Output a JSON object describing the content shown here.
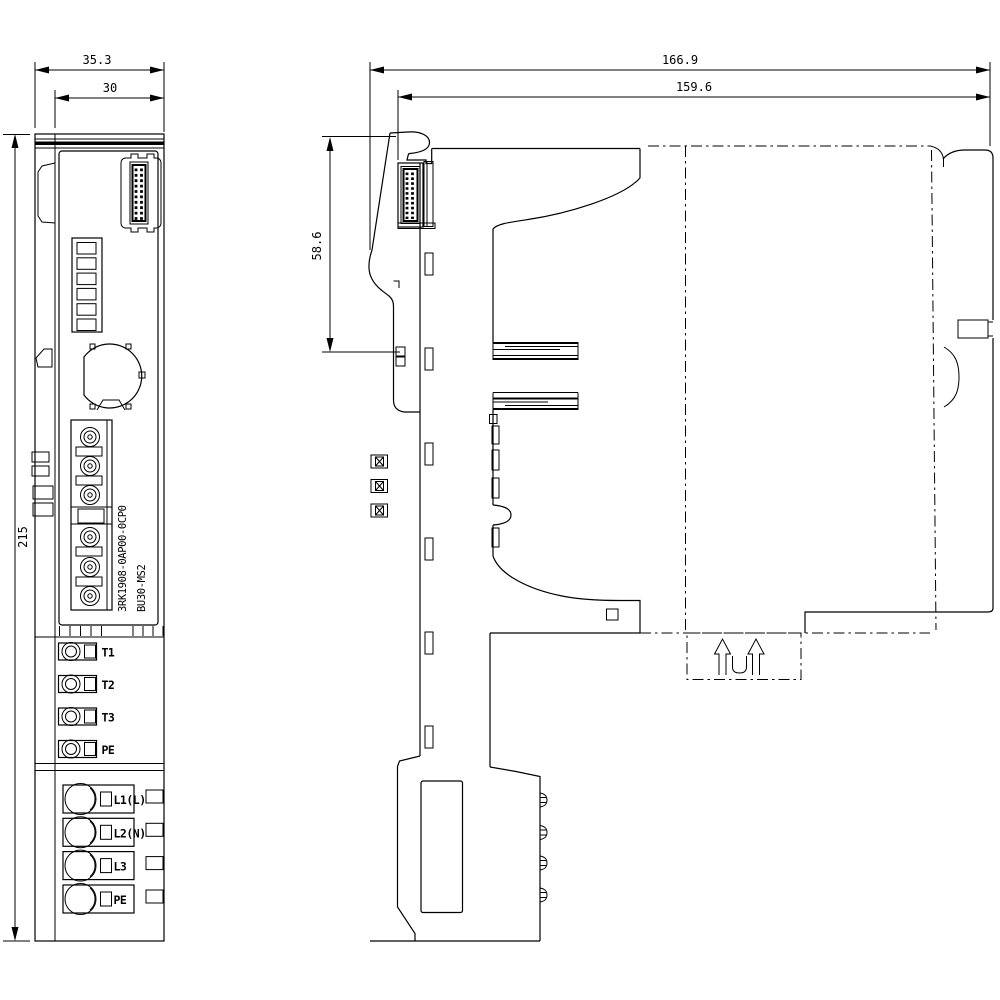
{
  "drawing_type": "dimensional drawing, front and side view",
  "dimensions": {
    "front_overall_width": "35.3",
    "front_device_width": "30",
    "front_height": "215",
    "side_overall_depth": "166.9",
    "side_device_depth": "159.6",
    "side_upper_section": "58.6"
  },
  "labels": {
    "order_number": "3RK1908-0AP00-0CP0",
    "module_name": "BU30-MS2"
  },
  "terminals": {
    "test": [
      "T1",
      "T2",
      "T3",
      "PE"
    ],
    "power": [
      "L1(L)",
      "L2(N)",
      "L3",
      "PE"
    ]
  },
  "colors": {
    "line": "#000000",
    "background": "#ffffff"
  }
}
